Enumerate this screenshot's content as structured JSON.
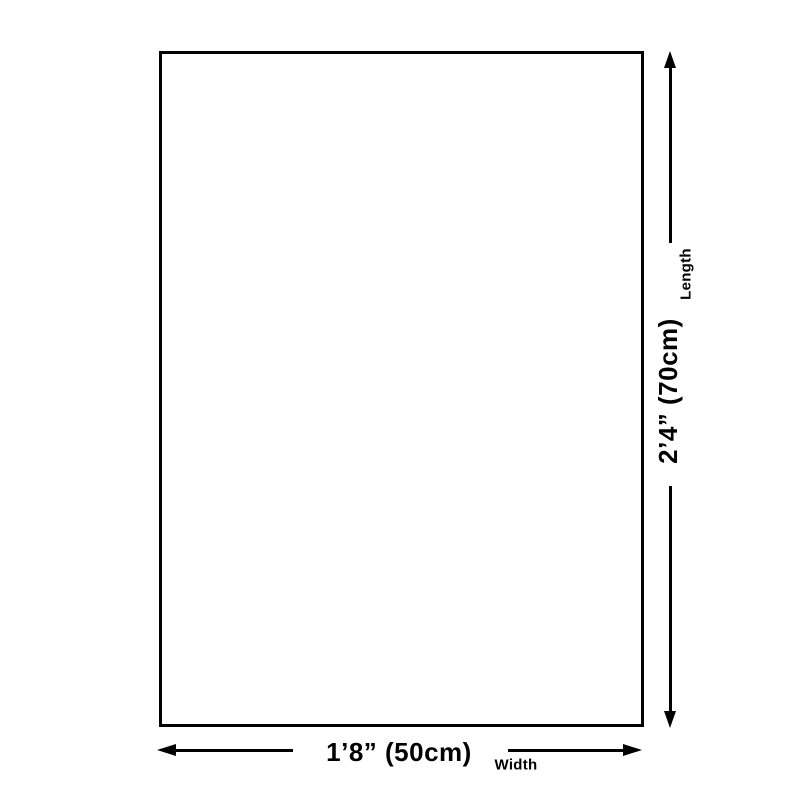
{
  "colors": {
    "background": "#ffffff",
    "line": "#000000",
    "text": "#000000"
  },
  "diagram": {
    "type": "product-dimension-diagram",
    "length": {
      "value": "2’4” (70cm)",
      "label": "Length"
    },
    "width": {
      "value": "1’8” (50cm)",
      "label": "Width"
    }
  }
}
